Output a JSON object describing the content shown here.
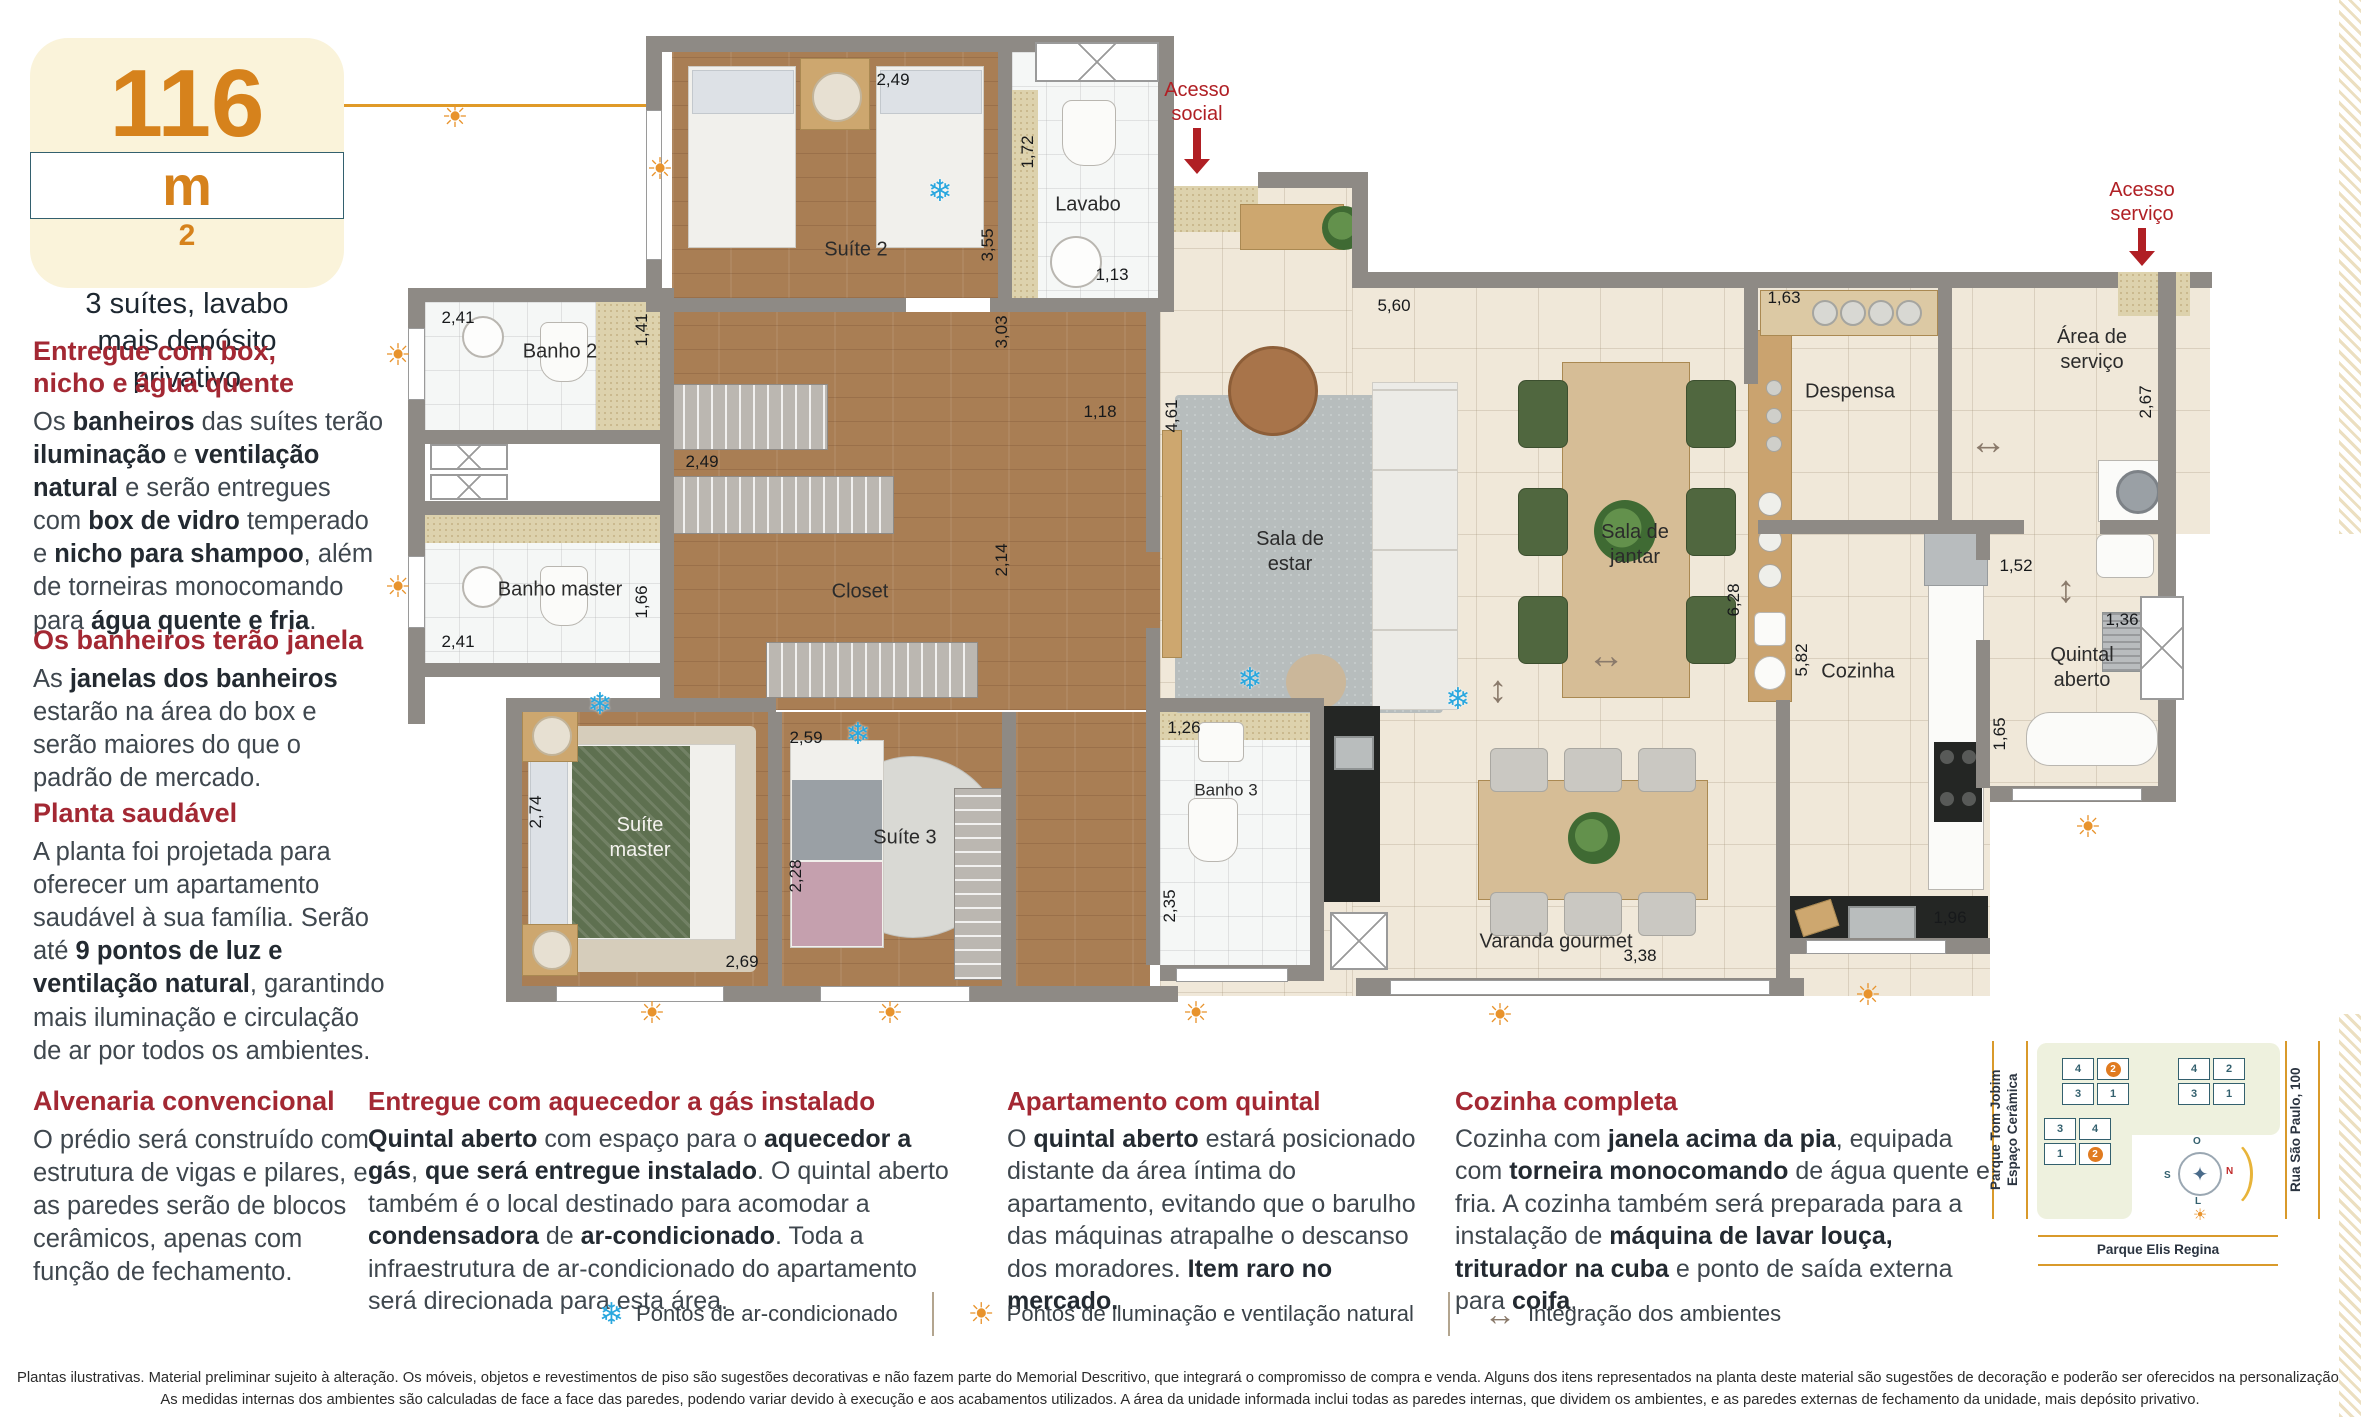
{
  "badge": {
    "value": "116",
    "unit": "m",
    "sup": "2",
    "subtitle": "3 suítes, lavabo\nmais depósito\nprivativo"
  },
  "articles_left": [
    {
      "heading": "Entregue com box,\nnicho e água quente",
      "body": [
        {
          "t": "Os "
        },
        {
          "t": "banheiros",
          "b": 1
        },
        {
          "t": " das suítes terão "
        },
        {
          "t": "iluminação",
          "b": 1
        },
        {
          "t": " e "
        },
        {
          "t": "ventilação natural",
          "b": 1
        },
        {
          "t": " e serão entregues com "
        },
        {
          "t": "box de vidro",
          "b": 1
        },
        {
          "t": " temperado e "
        },
        {
          "t": "nicho para shampoo",
          "b": 1
        },
        {
          "t": ", além de torneiras monocomando para "
        },
        {
          "t": "água quente e fria",
          "b": 1
        },
        {
          "t": "."
        }
      ]
    },
    {
      "heading": "Os banheiros terão janela",
      "body": [
        {
          "t": "As "
        },
        {
          "t": "janelas dos banheiros",
          "b": 1
        },
        {
          "t": " estarão na área do box e serão maiores do que o padrão de mercado."
        }
      ]
    },
    {
      "heading": "Planta saudável",
      "body": [
        {
          "t": "A planta foi projetada para oferecer um apartamento saudável à sua família. Serão até "
        },
        {
          "t": "9 pontos de luz e ventilação natural",
          "b": 1
        },
        {
          "t": ", garantindo mais iluminação e circulação de ar por todos os ambientes."
        }
      ]
    },
    {
      "heading": "Alvenaria convencional",
      "body": [
        {
          "t": "O prédio será construído com estrutura de vigas e pilares, e as paredes serão de blocos cerâmicos, apenas com função de fechamento."
        }
      ]
    }
  ],
  "articles_bottom": [
    {
      "heading": "Entregue com aquecedor a gás instalado",
      "body": [
        {
          "t": "Quintal aberto",
          "b": 1
        },
        {
          "t": " com espaço para o "
        },
        {
          "t": "aquecedor a gás",
          "b": 1
        },
        {
          "t": ", "
        },
        {
          "t": "que será entregue instalado",
          "b": 1
        },
        {
          "t": ". O quintal aberto também é o local destinado para acomodar a "
        },
        {
          "t": "condensadora",
          "b": 1
        },
        {
          "t": " de "
        },
        {
          "t": "ar-condicionado",
          "b": 1
        },
        {
          "t": ". Toda a infraestrutura de ar-condicionado do apartamento será direcionada para esta área."
        }
      ]
    },
    {
      "heading": "Apartamento com quintal",
      "body": [
        {
          "t": "O "
        },
        {
          "t": "quintal aberto",
          "b": 1
        },
        {
          "t": " estará posicionado distante da área íntima do apartamento, evitando que o barulho das máquinas atrapalhe o descanso dos moradores. "
        },
        {
          "t": "Item raro no mercado.",
          "b": 1
        }
      ]
    },
    {
      "heading": "Cozinha completa",
      "body": [
        {
          "t": "Cozinha com "
        },
        {
          "t": "janela acima da pia",
          "b": 1
        },
        {
          "t": ", equipada com "
        },
        {
          "t": "torneira monocomando",
          "b": 1
        },
        {
          "t": " de água quente e fria. A cozinha também será preparada para a instalação de "
        },
        {
          "t": "máquina de lavar louça, triturador na cuba",
          "b": 1
        },
        {
          "t": " e ponto de saída externa para "
        },
        {
          "t": "coifa",
          "b": 1
        },
        {
          "t": "."
        }
      ]
    }
  ],
  "legend": {
    "items": [
      {
        "icon": "snowflake-icon",
        "label": "Pontos de ar-condicionado"
      },
      {
        "icon": "sun-icon",
        "label": "Pontos de iluminação e ventilação natural"
      },
      {
        "icon": "double-arrow-icon",
        "label": "Integração dos ambientes"
      }
    ]
  },
  "disclaimer": "Plantas ilustrativas. Material preliminar sujeito à alteração. Os móveis, objetos e revestimentos de piso são sugestões decorativas e não fazem parte do Memorial Descritivo, que integrará o compromisso de compra e venda. Alguns dos itens representados na planta deste material são sugestões de decoração e poderão ser oferecidos na personalização. As medidas internas dos ambientes são calculadas de face a face das paredes, podendo variar devido à execução e aos acabamentos utilizados. A área da unidade informada inclui todas as paredes internas, que dividem os ambientes, e as paredes externas de fechamento da unidade, mais depósito privativo.",
  "floorplan": {
    "access": [
      "Acesso\nsocial",
      "Acesso\nserviço"
    ],
    "rooms": [
      "Suíte 2",
      "Lavabo",
      "Banho 2",
      "Banho master",
      "Closet",
      "Suíte\nmaster",
      "Suíte 3",
      "Banho 3",
      "Sala de\nestar",
      "Sala de\njantar",
      "Despensa",
      "Área de\nserviço",
      "Cozinha",
      "Quintal\naberto",
      "Varanda gourmet"
    ],
    "dims": [
      "2,49",
      "3,55",
      "1,72",
      "1,13",
      "2,41",
      "1,41",
      "2,41",
      "1,66",
      "2,49",
      "3,03",
      "2,14",
      "1,18",
      "2,74",
      "2,69",
      "2,59",
      "2,28",
      "1,26",
      "2,35",
      "4,61",
      "5,60",
      "1,63",
      "2,67",
      "6,28",
      "5,82",
      "1,52",
      "1,36",
      "1,65",
      "1,96",
      "3,38",
      "6,28"
    ]
  },
  "sitemap": {
    "left_label": "Parque Tom Jobim\nEspaço Cerâmica",
    "right_label": "Rua São Paulo, 100",
    "bottom_label": "Parque Elis Regina",
    "compass": {
      "top": "O",
      "right": "N",
      "left": "S",
      "bottom": "L"
    },
    "clusters": [
      {
        "units": [
          "4",
          "2",
          "3",
          "1"
        ]
      },
      {
        "units": [
          "4",
          "2",
          "3",
          "1"
        ]
      },
      {
        "units": [
          "3",
          "4",
          "1",
          "2"
        ]
      }
    ]
  }
}
